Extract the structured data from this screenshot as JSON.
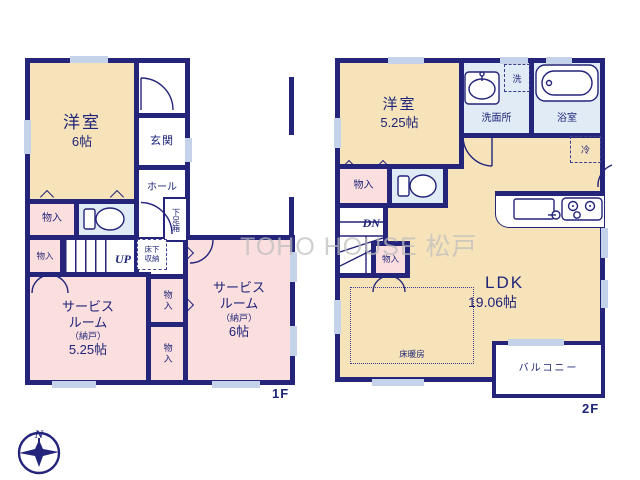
{
  "watermark": "TOHO HOUSE 松戸",
  "compass": {
    "north_label": "N"
  },
  "floor1": {
    "floor_label": "1F",
    "western_room": {
      "name": "洋室",
      "size": "6帖"
    },
    "entrance": "玄関",
    "hall": "ホール",
    "shoe_box": "下足箱",
    "underfloor_storage_l1": "床下",
    "underfloor_storage_l2": "収納",
    "stairs_up": "UP",
    "closet": "物入",
    "service_room_1": {
      "l1": "サービス",
      "l2": "ルーム",
      "l3": "（納戸）",
      "l4": "5.25帖"
    },
    "service_room_2": {
      "l1": "サービス",
      "l2": "ルーム",
      "l3": "（納戸）",
      "l4": "6帖"
    }
  },
  "floor2": {
    "floor_label": "2F",
    "western_room": {
      "name": "洋室",
      "size": "5.25帖"
    },
    "washroom": "洗面所",
    "laundry": "洗",
    "bathroom": "浴室",
    "refrigerator": "冷",
    "closet": "物入",
    "stairs_down": "DN",
    "ldk": {
      "name": "LDK",
      "size": "19.06帖"
    },
    "floor_heating": "床暖房",
    "balcony": "バルコニー"
  },
  "colors": {
    "wall": "#23247a",
    "ink": "#1e2478",
    "cream": "#f7e3ba",
    "pink": "#fbdede",
    "blue": "#e0ebf5",
    "wm": "#bdbdbd"
  }
}
